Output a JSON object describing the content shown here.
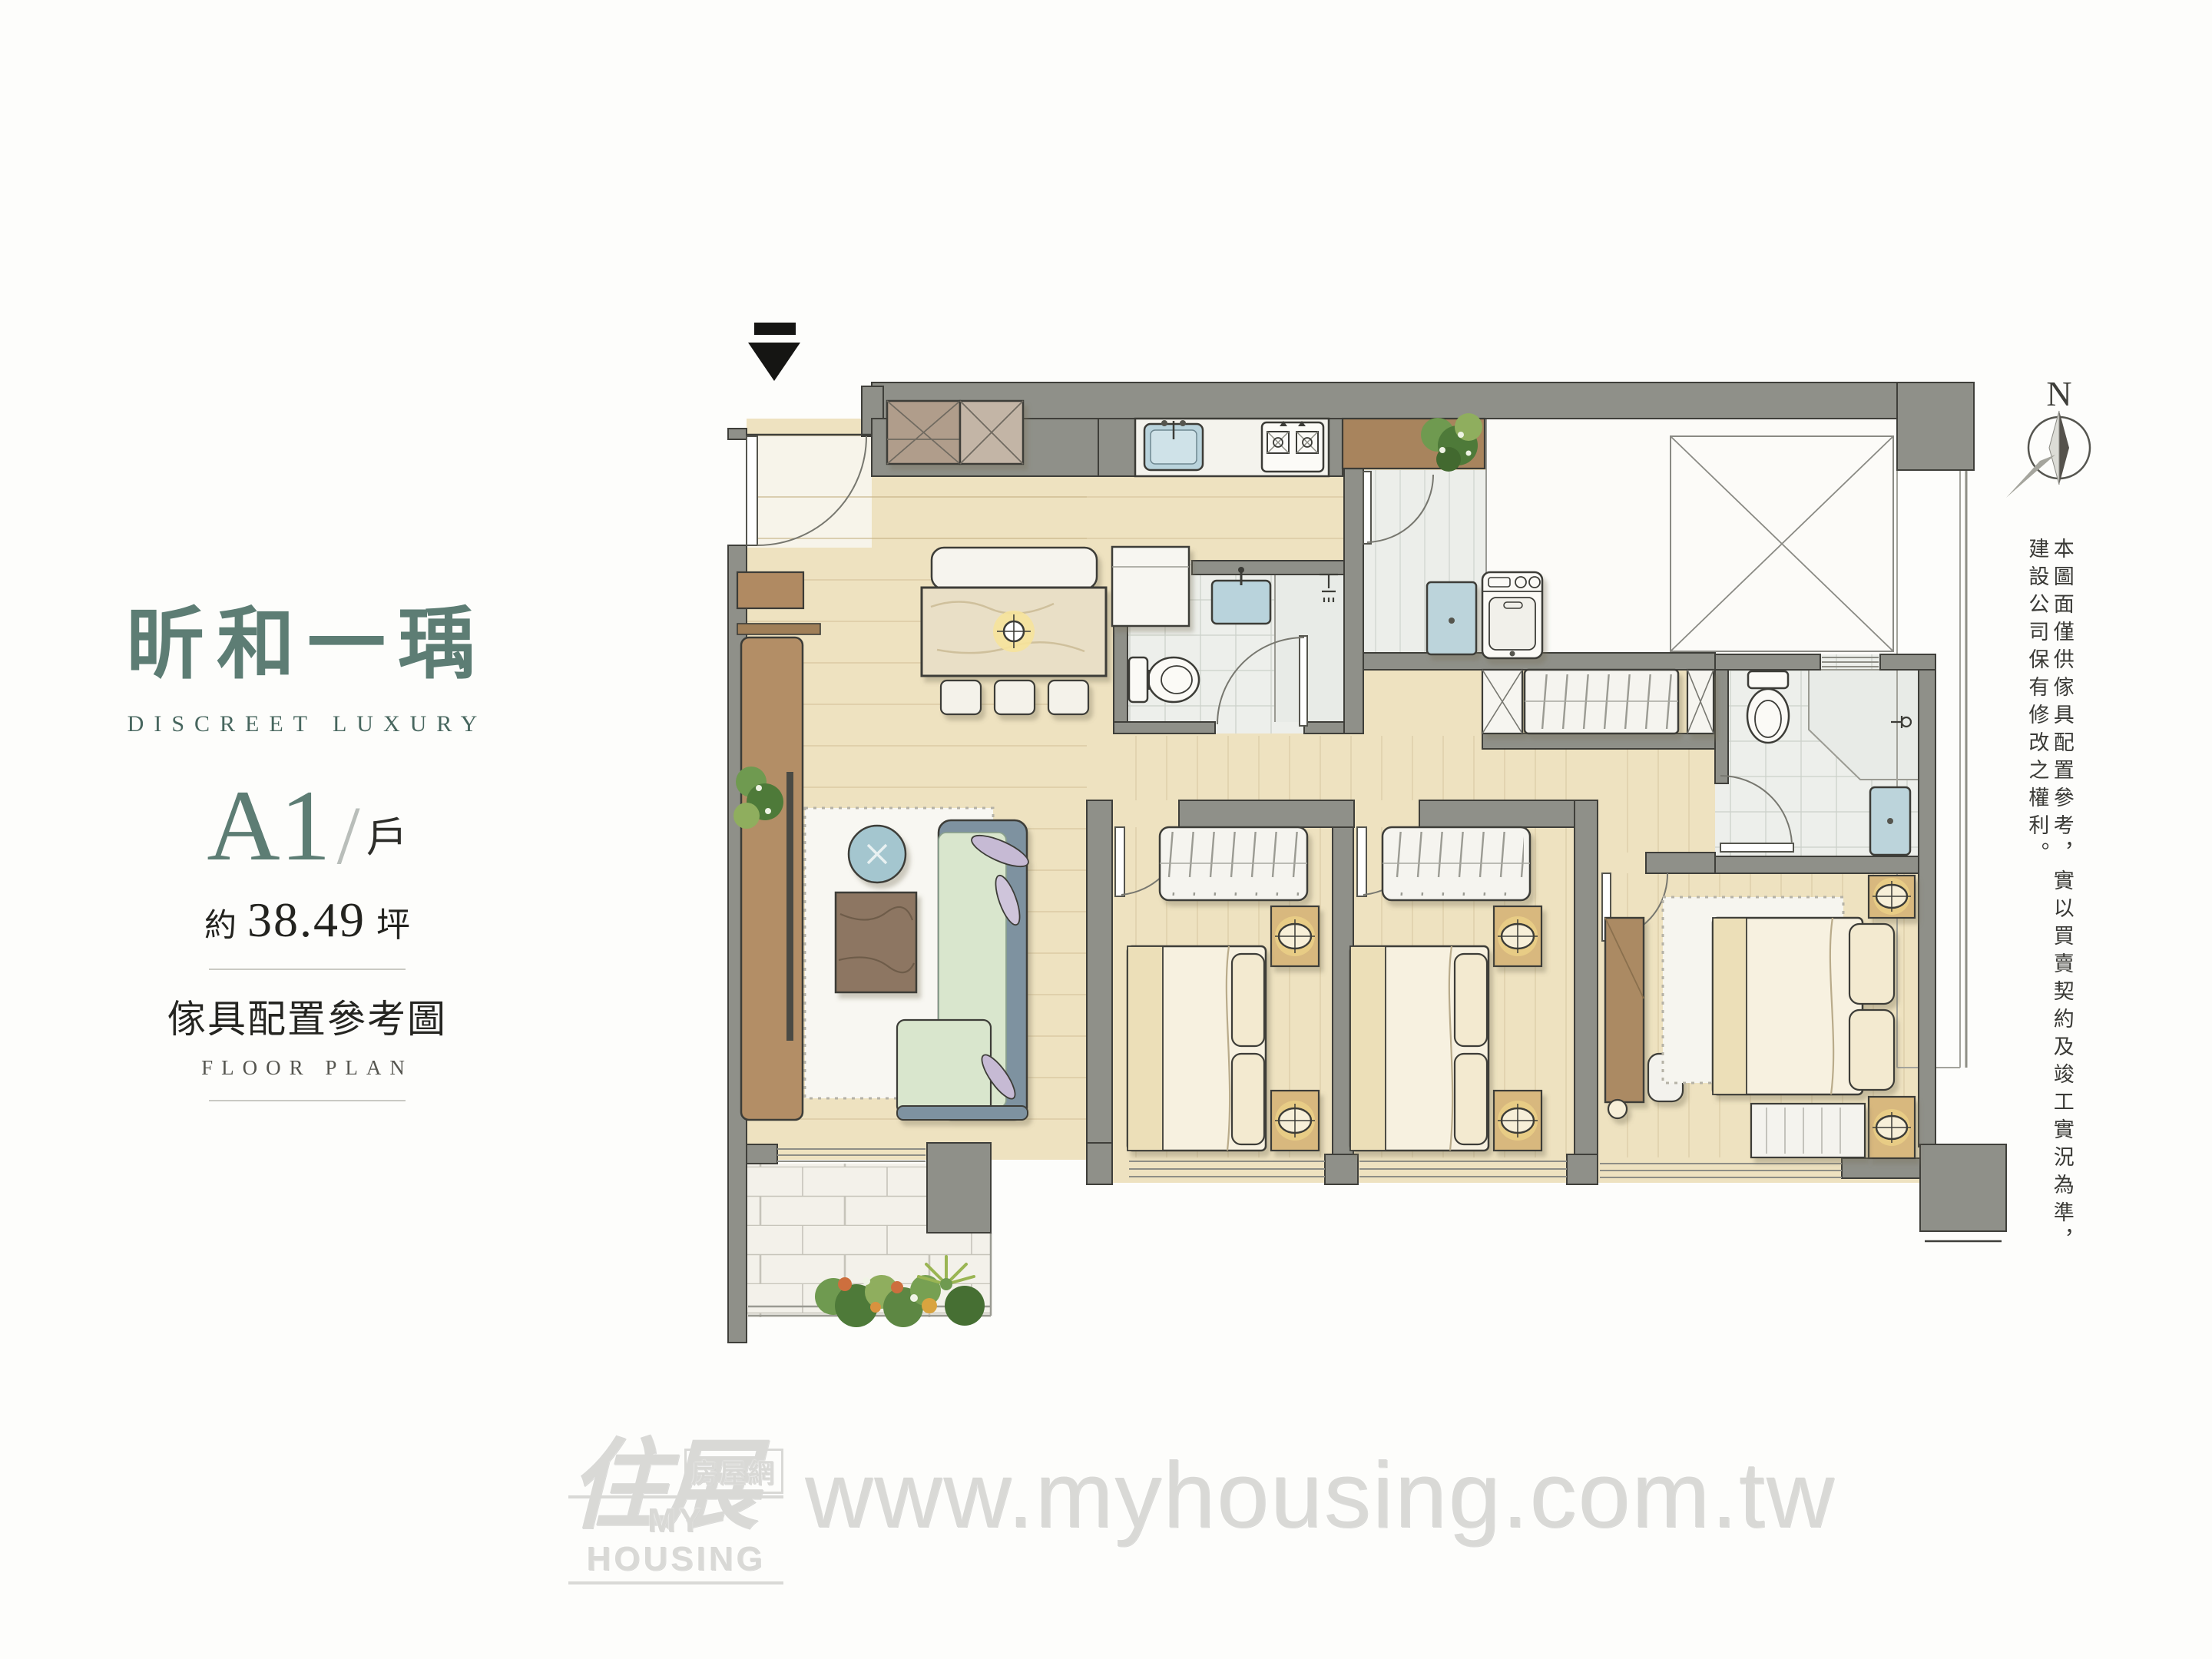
{
  "title": {
    "zh": "昕和一瑀",
    "en": "DISCREET LUXURY"
  },
  "unit": {
    "code": "A1",
    "divider": "/",
    "type_label": "戶",
    "area_prefix": "約",
    "area_value": "38.49",
    "area_unit": "坪"
  },
  "plan": {
    "label_zh": "傢具配置參考圖",
    "label_en": "FLOOR PLAN",
    "north_label": "N",
    "disclaimer": "本圖面僅供傢具配置參考，實以買賣契約及竣工實況為準，建設公司保有修改之權利。"
  },
  "watermark": {
    "brand_zh": "住展",
    "brand_sub": "房屋網",
    "brand_en": "MY HOUSING",
    "url": "www.myhousing.com.tw"
  },
  "colors": {
    "accent_teal": "#5d7d74",
    "wall_gray": "#8f9089",
    "floor_cream": "#eee2c0",
    "ink": "#2e2e2a"
  }
}
